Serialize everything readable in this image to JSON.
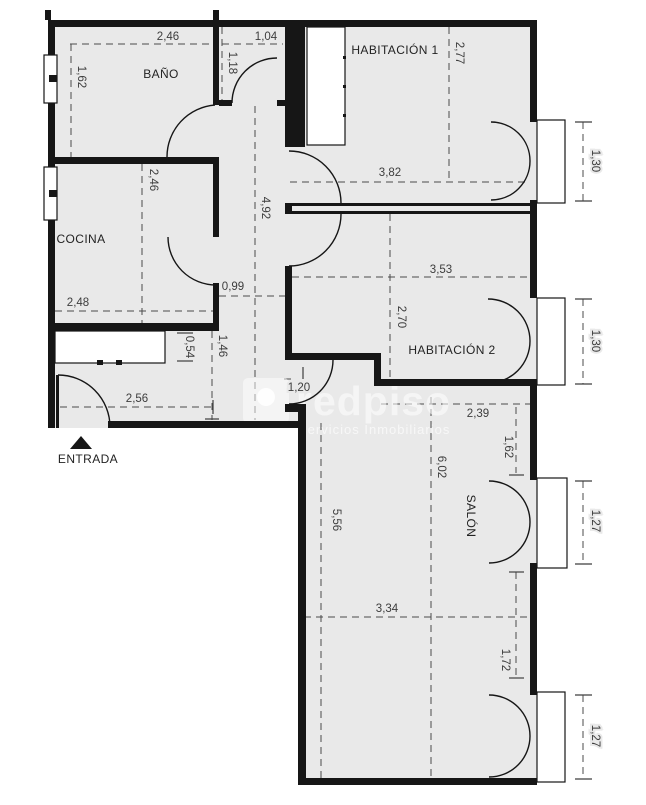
{
  "plan": {
    "type": "floor-plan",
    "rooms": {
      "banio": "BAÑO",
      "habitacion1": "HABITACIÓN 1",
      "cocina": "COCINA",
      "habitacion2": "HABITACIÓN 2",
      "salon": "SALÓN",
      "entrada": "ENTRADA"
    },
    "dimensions": {
      "banio_ancho": "2,46",
      "banio_fondo": "1,62",
      "pasillo_banio": "1,18",
      "pasillo_ancho_sup": "1,04",
      "habitacion1_fondo": "2,77",
      "habitacion1_ancho": "3,82",
      "balcon_habitacion1": "1,30",
      "cocina_fondo": "2,46",
      "cocina_ancho": "2,48",
      "pasillo_ancho": "0,99",
      "pasillo_largo": "4,92",
      "recibidor_fondo": "1,46",
      "armario_fondo": "0,54",
      "recibidor_ancho": "2,56",
      "puerta_salon": "1,20",
      "habitacion2_ancho": "3,53",
      "habitacion2_fondo": "2,70",
      "balcon_habitacion2": "1,30",
      "salon_ancho_sup": "2,39",
      "salon_tramo_sup": "1,62",
      "salon_largo": "6,02",
      "salon_largo_izq": "5,56",
      "balcon_salon_1": "1,27",
      "salon_tramo_balcones": "1,72",
      "salon_ancho_inf": "3,34",
      "balcon_salon_2": "1,27"
    },
    "watermark": {
      "brand": "redpiso",
      "tagline": "Servicios Inmobiliarios"
    },
    "colors": {
      "floor": "#e9e9e9",
      "wall": "#161616",
      "dim": "#3d3d3d",
      "paper": "#ffffff"
    }
  }
}
